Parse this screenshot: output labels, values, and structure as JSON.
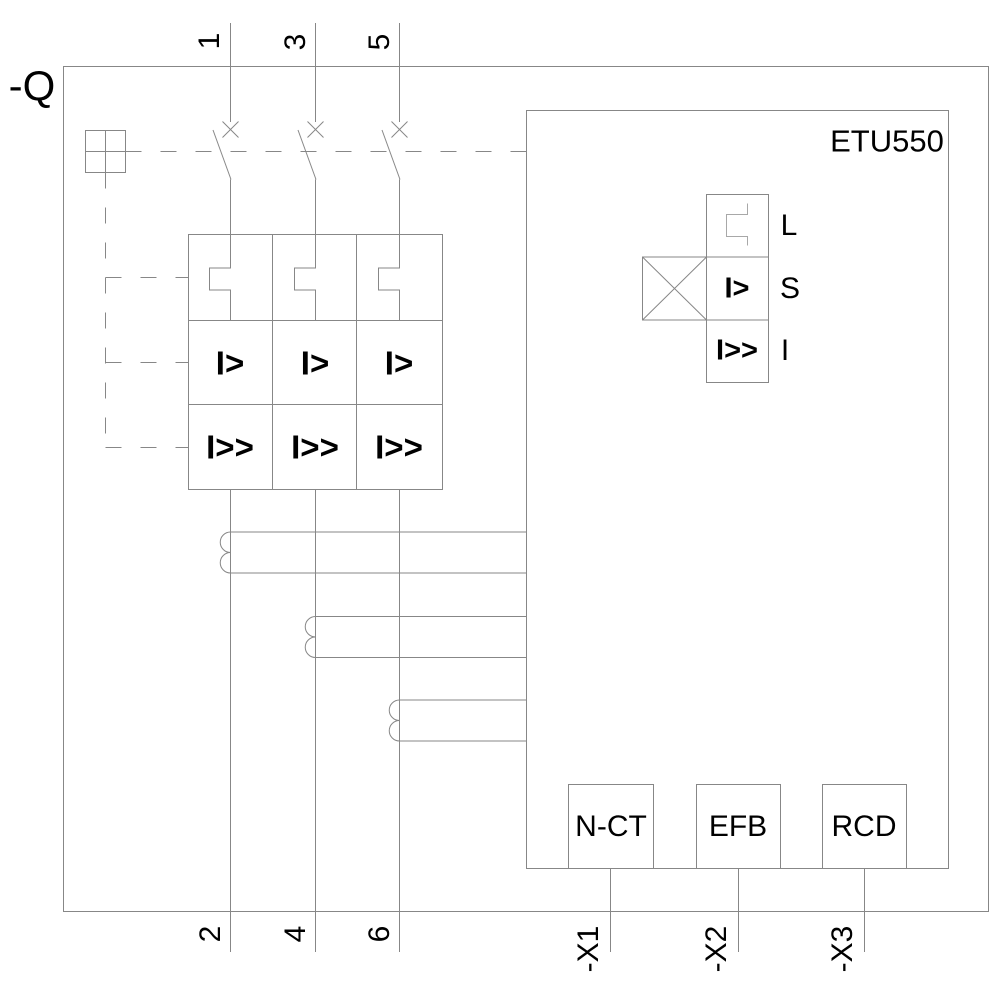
{
  "device_label": "-Q",
  "etu": {
    "name": "ETU550",
    "functions": [
      {
        "label": "L",
        "symbol": ""
      },
      {
        "label": "S",
        "symbol": "I>"
      },
      {
        "label": "I",
        "symbol": "I>>"
      }
    ],
    "modules": [
      "N-CT",
      "EFB",
      "RCD"
    ]
  },
  "terminals": {
    "top": [
      "1",
      "3",
      "5"
    ],
    "bottom": [
      "2",
      "4",
      "6"
    ],
    "aux": [
      "-X1",
      "-X2",
      "-X3"
    ]
  },
  "trip_grid": {
    "overcurrent_row": [
      "I>",
      "I>",
      "I>"
    ],
    "short_circuit_row": [
      "I>>",
      "I>>",
      "I>>"
    ]
  },
  "colors": {
    "line": "#878787",
    "light_line": "#a8a8a8",
    "text": "#000000",
    "background": "#ffffff"
  }
}
